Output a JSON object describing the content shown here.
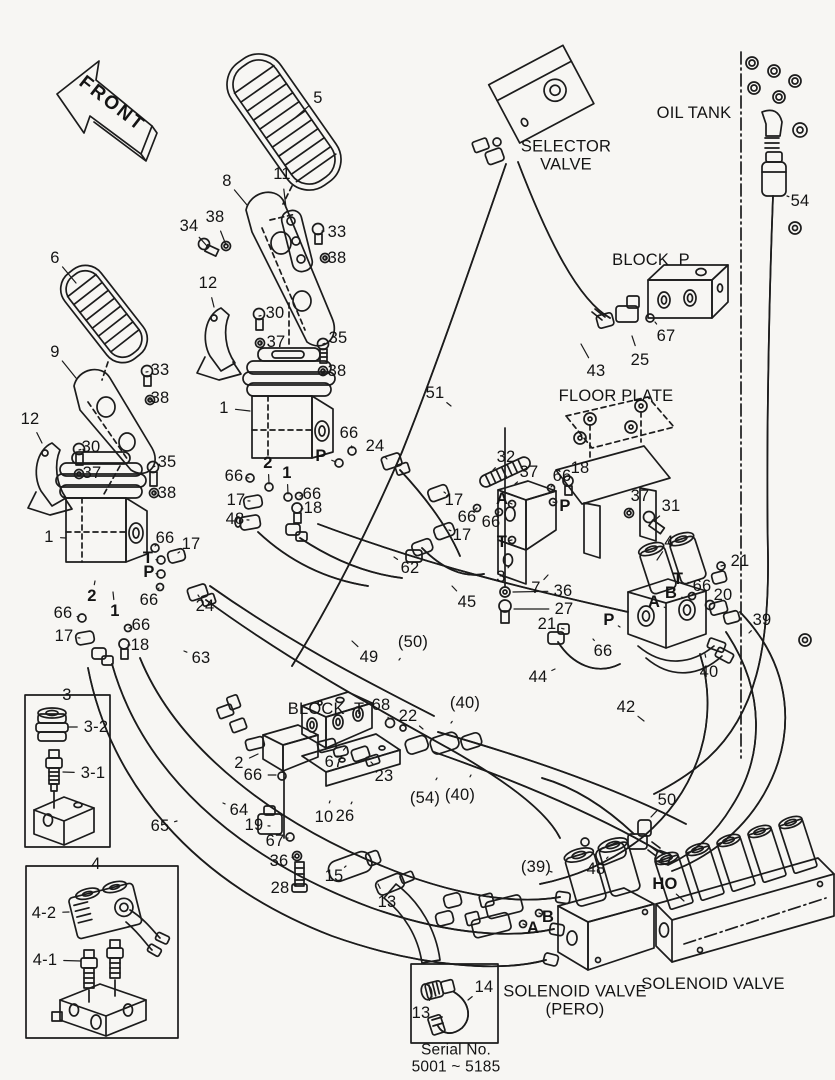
{
  "diagram": {
    "style": {
      "background": "#f7f6f3",
      "ink": "#1c1c1c"
    },
    "front_marker": {
      "t": "FRONT",
      "x": 112,
      "y": 104,
      "rot": 38,
      "s": 19
    },
    "component_labels": [
      {
        "t": "OIL TANK",
        "x": 694,
        "y": 113
      },
      {
        "t": "SELECTOR\nVALVE",
        "x": 566,
        "y": 156
      },
      {
        "t": "BLOCK  P",
        "x": 651,
        "y": 260
      },
      {
        "t": "FLOOR PLATE",
        "x": 616,
        "y": 396
      },
      {
        "t": "BLOCK  T",
        "x": 326,
        "y": 709
      },
      {
        "t": "SOLENOID VALVE\n(PERO)",
        "x": 575,
        "y": 1001
      },
      {
        "t": "SOLENOID VALVE",
        "x": 713,
        "y": 984
      },
      {
        "t": "Serial No.\n5001 ~ 5185",
        "x": 456,
        "y": 1059,
        "s": 15.5
      }
    ],
    "part_callouts": [
      {
        "t": "5",
        "x": 318,
        "y": 98,
        "lx": 296,
        "ly": 117
      },
      {
        "t": "8",
        "x": 227,
        "y": 181,
        "lx": 247,
        "ly": 205
      },
      {
        "t": "11",
        "x": 282,
        "y": 174,
        "lx": 286,
        "ly": 208
      },
      {
        "t": "34",
        "x": 189,
        "y": 226,
        "lx": 207,
        "ly": 246
      },
      {
        "t": "38",
        "x": 215,
        "y": 217,
        "lx": 226,
        "ly": 245
      },
      {
        "t": "33",
        "x": 337,
        "y": 232,
        "lx": 322,
        "ly": 231
      },
      {
        "t": "38",
        "x": 337,
        "y": 258,
        "lx": 325,
        "ly": 258
      },
      {
        "t": "6",
        "x": 55,
        "y": 258,
        "lx": 76,
        "ly": 283
      },
      {
        "t": "12",
        "x": 208,
        "y": 283,
        "lx": 214,
        "ly": 307
      },
      {
        "t": "30",
        "x": 275,
        "y": 313,
        "lx": 259,
        "ly": 316
      },
      {
        "t": "37",
        "x": 276,
        "y": 342,
        "lx": 260,
        "ly": 343
      },
      {
        "t": "35",
        "x": 338,
        "y": 338,
        "lx": 323,
        "ly": 344
      },
      {
        "t": "38",
        "x": 337,
        "y": 371,
        "lx": 323,
        "ly": 371
      },
      {
        "t": "9",
        "x": 55,
        "y": 352,
        "lx": 76,
        "ly": 378
      },
      {
        "t": "33",
        "x": 160,
        "y": 370,
        "lx": 146,
        "ly": 372
      },
      {
        "t": "38",
        "x": 160,
        "y": 398,
        "lx": 149,
        "ly": 400
      },
      {
        "t": "12",
        "x": 30,
        "y": 419,
        "lx": 42,
        "ly": 443
      },
      {
        "t": "30",
        "x": 91,
        "y": 447,
        "lx": 79,
        "ly": 450
      },
      {
        "t": "37",
        "x": 92,
        "y": 473,
        "lx": 79,
        "ly": 474
      },
      {
        "t": "35",
        "x": 167,
        "y": 462,
        "lx": 153,
        "ly": 467
      },
      {
        "t": "38",
        "x": 167,
        "y": 493,
        "lx": 154,
        "ly": 493
      },
      {
        "t": "1",
        "x": 224,
        "y": 408,
        "lx": 250,
        "ly": 411
      },
      {
        "t": "1",
        "x": 49,
        "y": 537,
        "lx": 66,
        "ly": 538
      },
      {
        "t": "66",
        "x": 349,
        "y": 433,
        "lx": 352,
        "ly": 448
      },
      {
        "t": "24",
        "x": 375,
        "y": 446,
        "lx": 387,
        "ly": 459
      },
      {
        "t": "66",
        "x": 234,
        "y": 476,
        "lx": 249,
        "ly": 478
      },
      {
        "t": "17",
        "x": 236,
        "y": 500,
        "lx": 250,
        "ly": 501
      },
      {
        "t": "66",
        "x": 312,
        "y": 494,
        "lx": 300,
        "ly": 496
      },
      {
        "t": "18",
        "x": 313,
        "y": 508,
        "lx": 301,
        "ly": 509
      },
      {
        "t": "48",
        "x": 235,
        "y": 519,
        "lx": 249,
        "ly": 520
      },
      {
        "t": "51",
        "x": 435,
        "y": 393,
        "lx": 451,
        "ly": 406
      },
      {
        "t": "43",
        "x": 596,
        "y": 371,
        "lx": 581,
        "ly": 344
      },
      {
        "t": "25",
        "x": 640,
        "y": 360,
        "lx": 632,
        "ly": 336
      },
      {
        "t": "67",
        "x": 666,
        "y": 336,
        "lx": 655,
        "ly": 322
      },
      {
        "t": "54",
        "x": 800,
        "y": 201,
        "lx": 787,
        "ly": 196
      },
      {
        "t": "62",
        "x": 410,
        "y": 568,
        "lx": 394,
        "ly": 557
      },
      {
        "t": "66",
        "x": 165,
        "y": 538,
        "lx": 155,
        "ly": 546
      },
      {
        "t": "17",
        "x": 191,
        "y": 544,
        "lx": 178,
        "ly": 553
      },
      {
        "t": "66",
        "x": 149,
        "y": 600,
        "lx": 159,
        "ly": 588
      },
      {
        "t": "24",
        "x": 205,
        "y": 606,
        "lx": 198,
        "ly": 595
      },
      {
        "t": "66",
        "x": 63,
        "y": 613,
        "lx": 79,
        "ly": 617
      },
      {
        "t": "17",
        "x": 64,
        "y": 636,
        "lx": 80,
        "ly": 638
      },
      {
        "t": "66",
        "x": 141,
        "y": 625,
        "lx": 129,
        "ly": 628
      },
      {
        "t": "18",
        "x": 140,
        "y": 645,
        "lx": 128,
        "ly": 645
      },
      {
        "t": "63",
        "x": 201,
        "y": 658,
        "lx": 184,
        "ly": 651
      },
      {
        "t": "49",
        "x": 369,
        "y": 657,
        "lx": 352,
        "ly": 641
      },
      {
        "t": "45",
        "x": 467,
        "y": 602,
        "lx": 452,
        "ly": 586
      },
      {
        "t": "32",
        "x": 506,
        "y": 457,
        "lx": 493,
        "ly": 470
      },
      {
        "t": "37",
        "x": 529,
        "y": 472,
        "lx": 515,
        "ly": 484
      },
      {
        "t": "66",
        "x": 562,
        "y": 476,
        "lx": 551,
        "ly": 487
      },
      {
        "t": "18",
        "x": 580,
        "y": 468,
        "lx": 568,
        "ly": 480
      },
      {
        "t": "17",
        "x": 454,
        "y": 500,
        "lx": 444,
        "ly": 492
      },
      {
        "t": "66",
        "x": 467,
        "y": 517,
        "lx": 477,
        "ly": 508
      },
      {
        "t": "66",
        "x": 491,
        "y": 522,
        "lx": 499,
        "ly": 512
      },
      {
        "t": "17",
        "x": 462,
        "y": 535,
        "lx": 449,
        "ly": 530
      },
      {
        "t": "3",
        "x": 501,
        "y": 577,
        "lx": 511,
        "ly": 564
      },
      {
        "t": "7",
        "x": 536,
        "y": 588,
        "lx": 548,
        "ly": 575
      },
      {
        "t": "36",
        "x": 563,
        "y": 591,
        "lx": 513,
        "ly": 592
      },
      {
        "t": "27",
        "x": 564,
        "y": 609,
        "lx": 514,
        "ly": 609
      },
      {
        "t": "21",
        "x": 547,
        "y": 624,
        "lx": 564,
        "ly": 629
      },
      {
        "t": "66",
        "x": 603,
        "y": 651,
        "lx": 593,
        "ly": 639
      },
      {
        "t": "44",
        "x": 538,
        "y": 677,
        "lx": 555,
        "ly": 669
      },
      {
        "t": "37",
        "x": 640,
        "y": 496,
        "lx": 629,
        "ly": 511
      },
      {
        "t": "31",
        "x": 671,
        "y": 506,
        "lx": 655,
        "ly": 520
      },
      {
        "t": "4",
        "x": 669,
        "y": 542,
        "lx": 657,
        "ly": 560
      },
      {
        "t": "21",
        "x": 740,
        "y": 561,
        "lx": 721,
        "ly": 566
      },
      {
        "t": "66",
        "x": 702,
        "y": 586,
        "lx": 692,
        "ly": 595
      },
      {
        "t": "20",
        "x": 723,
        "y": 595,
        "lx": 710,
        "ly": 605
      },
      {
        "t": "39",
        "x": 762,
        "y": 620,
        "lx": 749,
        "ly": 633
      },
      {
        "t": "40",
        "x": 709,
        "y": 672,
        "lx": 705,
        "ly": 654
      },
      {
        "t": "42",
        "x": 626,
        "y": 707,
        "lx": 644,
        "ly": 721
      },
      {
        "t": "68",
        "x": 381,
        "y": 705,
        "lx": 389,
        "ly": 719
      },
      {
        "t": "22",
        "x": 408,
        "y": 716,
        "lx": 423,
        "ly": 729
      },
      {
        "t": "2",
        "x": 239,
        "y": 763,
        "lx": 258,
        "ly": 754
      },
      {
        "t": "66",
        "x": 253,
        "y": 775,
        "lx": 276,
        "ly": 775
      },
      {
        "t": "67",
        "x": 334,
        "y": 762,
        "lx": 346,
        "ly": 747
      },
      {
        "t": "23",
        "x": 384,
        "y": 776,
        "lx": 371,
        "ly": 762
      },
      {
        "t": "64",
        "x": 239,
        "y": 810,
        "lx": 223,
        "ly": 803
      },
      {
        "t": "65",
        "x": 160,
        "y": 826,
        "lx": 177,
        "ly": 821
      },
      {
        "t": "19",
        "x": 254,
        "y": 825,
        "lx": 270,
        "ly": 826
      },
      {
        "t": "10",
        "x": 324,
        "y": 817,
        "lx": 330,
        "ly": 801
      },
      {
        "t": "26",
        "x": 345,
        "y": 816,
        "lx": 352,
        "ly": 802
      },
      {
        "t": "67",
        "x": 275,
        "y": 841,
        "lx": 288,
        "ly": 838
      },
      {
        "t": "36",
        "x": 279,
        "y": 861,
        "lx": 294,
        "ly": 857
      },
      {
        "t": "15",
        "x": 334,
        "y": 876,
        "lx": 346,
        "ly": 866
      },
      {
        "t": "28",
        "x": 280,
        "y": 888,
        "lx": 296,
        "ly": 885
      },
      {
        "t": "13",
        "x": 387,
        "y": 902,
        "lx": 378,
        "ly": 884
      },
      {
        "t": "48",
        "x": 596,
        "y": 869,
        "lx": 608,
        "ly": 857
      },
      {
        "t": "50",
        "x": 667,
        "y": 800,
        "lx": 651,
        "ly": 817
      },
      {
        "t": "14",
        "x": 484,
        "y": 987,
        "lx": 468,
        "ly": 1000
      },
      {
        "t": "13",
        "x": 421,
        "y": 1013,
        "lx": 431,
        "ly": 998
      },
      {
        "t": "3",
        "x": 67,
        "y": 695
      },
      {
        "t": "3-2",
        "x": 96,
        "y": 727,
        "lx": 69,
        "ly": 727
      },
      {
        "t": "3-1",
        "x": 93,
        "y": 773,
        "lx": 63,
        "ly": 772
      },
      {
        "t": "4",
        "x": 96,
        "y": 864
      },
      {
        "t": "4-2",
        "x": 44,
        "y": 913,
        "lx": 69,
        "ly": 912
      },
      {
        "t": "4-1",
        "x": 45,
        "y": 960,
        "lx": 81,
        "ly": 961
      }
    ],
    "port_letters": [
      {
        "t": "P",
        "x": 321,
        "y": 456,
        "b": true,
        "lx": 336,
        "ly": 462
      },
      {
        "t": "2",
        "x": 268,
        "y": 463,
        "b": true,
        "lx": 269,
        "ly": 484
      },
      {
        "t": "1",
        "x": 287,
        "y": 473,
        "b": true,
        "lx": 288,
        "ly": 494
      },
      {
        "t": "T",
        "x": 148,
        "y": 558,
        "b": true,
        "lx": 158,
        "ly": 560
      },
      {
        "t": "P",
        "x": 149,
        "y": 572,
        "b": true,
        "lx": 158,
        "ly": 574
      },
      {
        "t": "2",
        "x": 92,
        "y": 596,
        "b": true,
        "lx": 95,
        "ly": 581
      },
      {
        "t": "1",
        "x": 115,
        "y": 611,
        "b": true,
        "lx": 113,
        "ly": 592
      },
      {
        "t": "A",
        "x": 502,
        "y": 499,
        "b": true,
        "lx": 512,
        "ly": 504
      },
      {
        "t": "P",
        "x": 565,
        "y": 506,
        "b": true,
        "lx": 553,
        "ly": 502
      },
      {
        "t": "T",
        "x": 502,
        "y": 542,
        "b": true,
        "lx": 512,
        "ly": 540
      },
      {
        "t": "P",
        "x": 609,
        "y": 620,
        "b": true,
        "lx": 620,
        "ly": 627
      },
      {
        "t": "T",
        "x": 678,
        "y": 579,
        "b": true,
        "lx": 690,
        "ly": 583
      },
      {
        "t": "B",
        "x": 671,
        "y": 593,
        "b": true,
        "lx": 684,
        "ly": 598
      },
      {
        "t": "A",
        "x": 654,
        "y": 602,
        "b": true,
        "lx": 666,
        "ly": 608
      },
      {
        "t": "HO",
        "x": 665,
        "y": 884,
        "b": true,
        "lx": 684,
        "ly": 901
      },
      {
        "t": "B",
        "x": 548,
        "y": 917,
        "b": true,
        "lx": 539,
        "ly": 913
      },
      {
        "t": "A",
        "x": 533,
        "y": 928,
        "b": true,
        "lx": 523,
        "ly": 924
      }
    ],
    "hose_refs": [
      {
        "t": "(50)",
        "x": 413,
        "y": 642,
        "lx": 399,
        "ly": 660
      },
      {
        "t": "(40)",
        "x": 465,
        "y": 703,
        "lx": 451,
        "ly": 723
      },
      {
        "t": "(54)",
        "x": 425,
        "y": 798,
        "lx": 437,
        "ly": 778
      },
      {
        "t": "(40)",
        "x": 460,
        "y": 795,
        "lx": 471,
        "ly": 775
      },
      {
        "t": "(39)",
        "x": 536,
        "y": 867,
        "lx": 552,
        "ly": 872
      }
    ]
  }
}
